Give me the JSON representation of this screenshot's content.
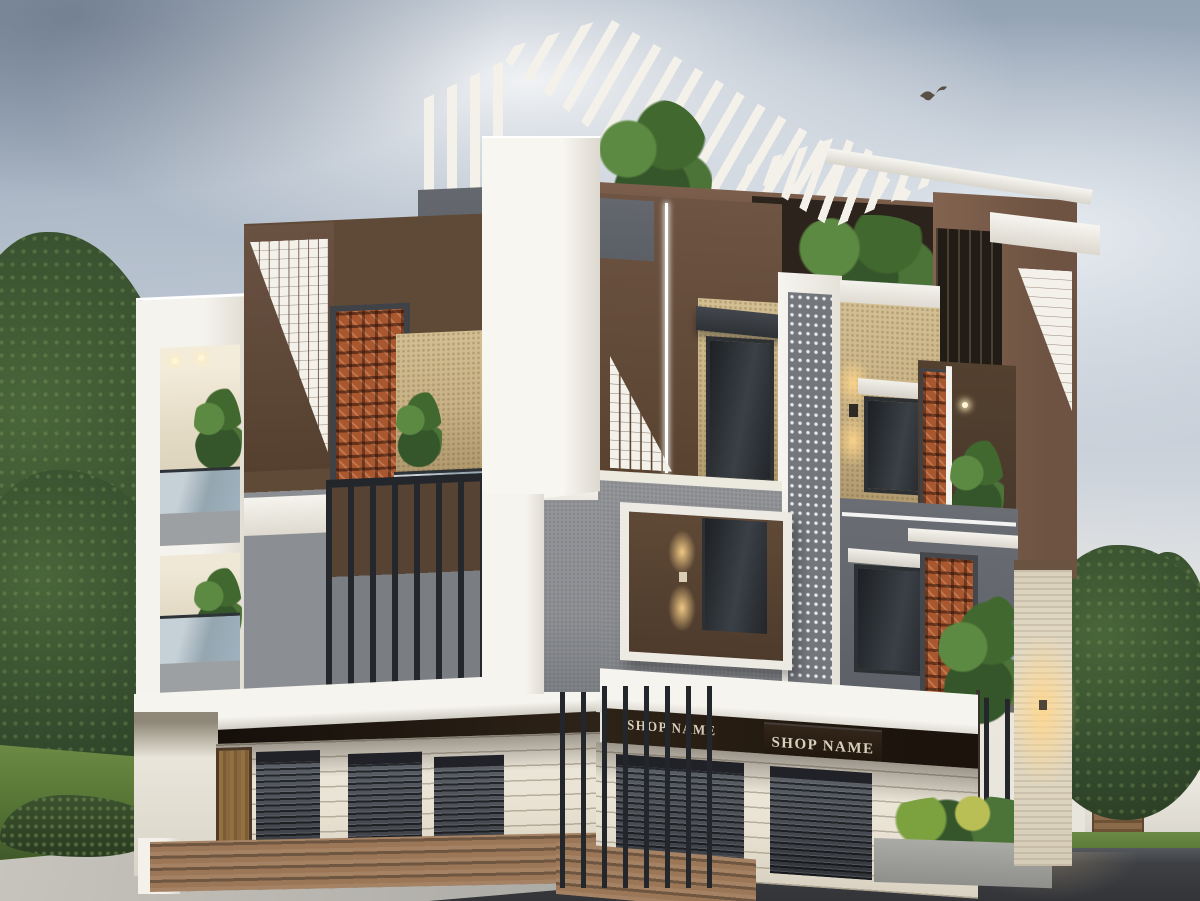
{
  "scene": {
    "setting": "3D exterior render of a modern three-storey building with ground-floor shops, overcast sky, wet road",
    "floors_visible": 3
  },
  "signs": [
    {
      "text": "SHOP NAME"
    },
    {
      "text": "SHOP NAME"
    }
  ],
  "storefront": {
    "left_shutter_count": 3,
    "right_shutter_count": 2,
    "door_count": 1
  },
  "colors": {
    "white": "#f3f1ea",
    "cream": "#e9e2d3",
    "brown": "#5f4937",
    "brown_light": "#7c5e4b",
    "terracotta": "#a8572f",
    "slate": "#5b5f66",
    "concrete": "#8f9195",
    "glass": "#9fb2bf",
    "louvre": "#24282d",
    "shutter": "#4a4d53",
    "fascia": "#231a12",
    "sign_text": "#d8cfbc",
    "gold": "#c8b184",
    "glow": "#ffd489",
    "wood": "#8a6742",
    "step": "#9b7757",
    "road": "#3e4044",
    "lawn": "#557434",
    "tree": "#3a5130",
    "sky_top": "#93a2b4",
    "sky_low": "#e7e4da"
  }
}
